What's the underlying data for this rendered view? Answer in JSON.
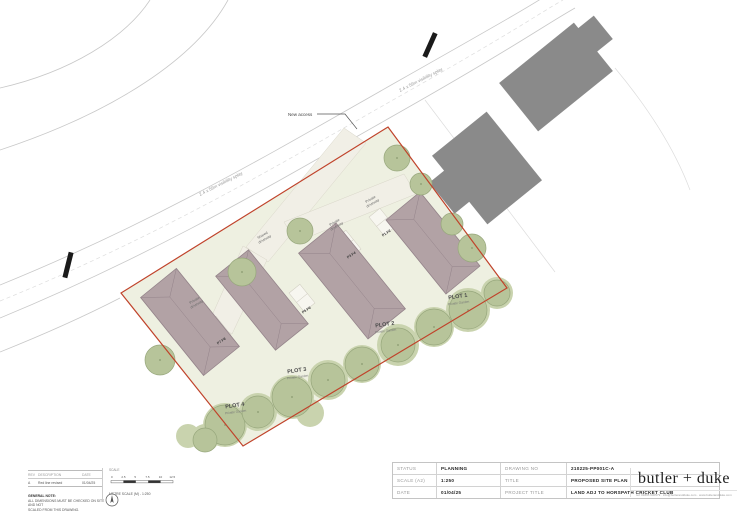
{
  "plan": {
    "colors": {
      "site_fill": "#eef0e1",
      "boundary_red": "#c0432b",
      "house_fill": "#b2a2a5",
      "garden_fill": "#c9d3ae",
      "tree_fill": "#b7c49a",
      "building_gray": "#8a8a8a",
      "driveway_fill": "#f1efe6",
      "road_line": "#c8c8c8"
    },
    "labels": {
      "new_access": "New access",
      "visibility_splay": "2.4 x 59m visibility splay",
      "shared_l1": "Shared",
      "shared_l2": "driveway",
      "private_l1": "Private",
      "private_l2": "driveway"
    },
    "plots": [
      {
        "name": "PLOT 1",
        "sub": "Private Garden"
      },
      {
        "name": "PLOT 2",
        "sub": "Private Garden"
      },
      {
        "name": "PLOT 3",
        "sub": "Private Garden"
      },
      {
        "name": "PLOT 4",
        "sub": "Private Garden"
      }
    ],
    "parking": [
      "P1 P2",
      "P3 P4",
      "P5 P6",
      "P7 P8"
    ]
  },
  "revisions": {
    "headers": [
      "REV",
      "DESCRIPTION",
      "DATE"
    ],
    "rows": [
      [
        "A",
        "Red line revised",
        "01/04/25"
      ]
    ]
  },
  "notes": {
    "general_title": "GENERAL NOTE:",
    "general_line1": "ALL DIMENSIONS MUST BE CHECKED ON SITE AND NOT",
    "general_line2": "SCALED FROM THIS DRAWING."
  },
  "scale_bar": {
    "heading": "SCALE",
    "ticks": [
      "0",
      "2.5",
      "5",
      "7.5",
      "10",
      "12.5"
    ],
    "caption": "METRE SCALE (M) - 1:250"
  },
  "title_block": {
    "rows": [
      {
        "l1": "STATUS",
        "v1": "PLANNING",
        "l2": "DRAWING NO",
        "v2": "210225-PP001C-A"
      },
      {
        "l1": "SCALE (A2)",
        "v1": "1:250",
        "l2": "TITLE",
        "v2": "PROPOSED SITE PLAN"
      },
      {
        "l1": "DATE",
        "v1": "01/04/25",
        "l2": "PROJECT TITLE",
        "v2": "LAND ADJ TO HORSPATH CRICKET CLUB"
      }
    ],
    "logo": "butler + duke",
    "logo_contact": "tel: 01865 600579 · info@butlerandduke.com · www.butlerandduke.com"
  }
}
